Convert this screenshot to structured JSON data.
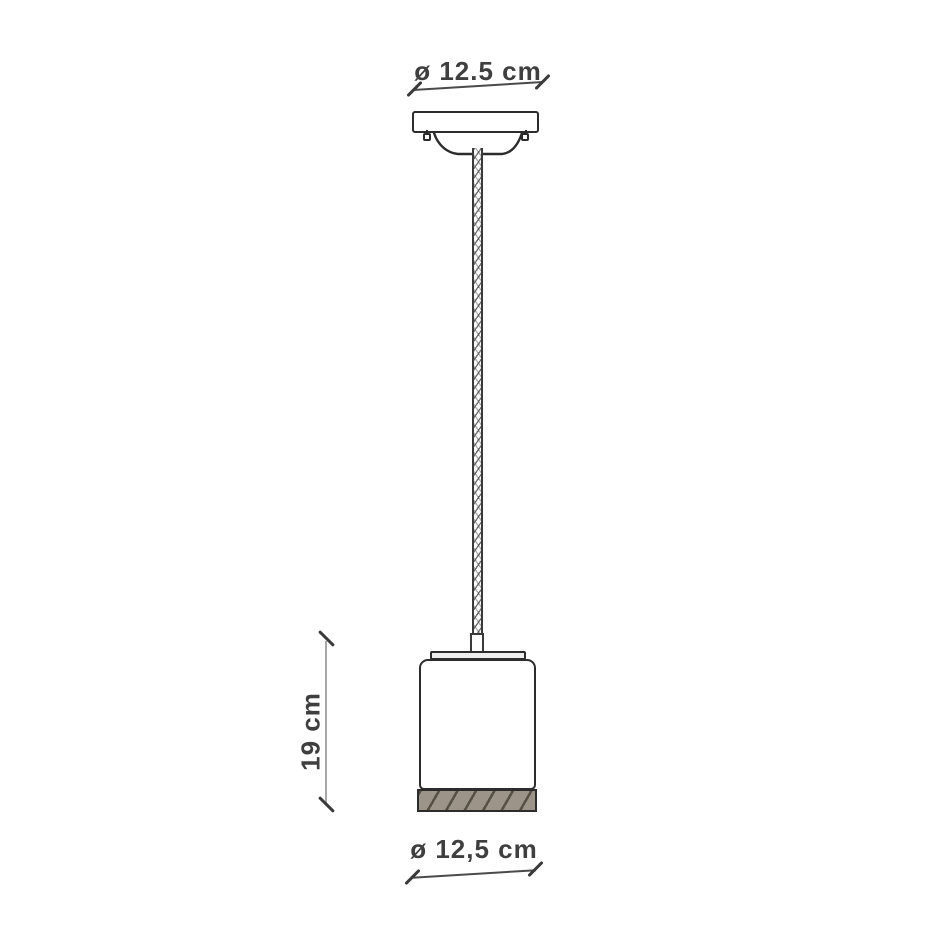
{
  "diagram": {
    "labels": {
      "top_diameter": "ø 12.5 cm",
      "height": "19 cm",
      "bottom_diameter": "ø 12,5 cm"
    },
    "colors": {
      "background": "#ffffff",
      "outline": "#2c2c2c",
      "dimension_line": "#4a4a4a",
      "dimension_tick": "#3a3a3a",
      "extension_line": "#a8a8a8",
      "label_text": "#3f3f3f",
      "base_band_fill": "#9c9488",
      "base_band_hatch": "#564f45",
      "cap_fill": "#ededed"
    },
    "parts": [
      "ceiling-canopy",
      "braided-cable",
      "socket-cover",
      "shade-top-cap",
      "cylindrical-shade",
      "base-band"
    ]
  }
}
